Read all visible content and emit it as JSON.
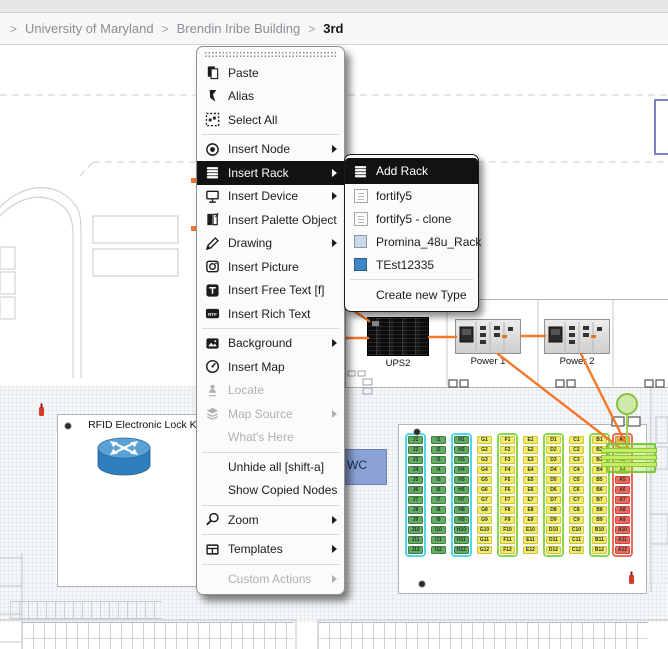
{
  "breadcrumb": {
    "separator": ">",
    "items": [
      {
        "label": "University of Maryland"
      },
      {
        "label": "Brendin Iribe Building"
      },
      {
        "label": "3rd",
        "current": true
      }
    ]
  },
  "context_menu": {
    "rtf_icon_text": "RTF",
    "items": [
      {
        "label": "Paste",
        "icon": "paste-icon"
      },
      {
        "label": "Alias",
        "icon": "alias-icon"
      },
      {
        "label": "Select All",
        "icon": "select-all-icon",
        "separator_after": true
      },
      {
        "label": "Insert Node",
        "icon": "node-icon",
        "submenu": true
      },
      {
        "label": "Insert Rack",
        "icon": "rack-icon",
        "submenu": true,
        "highlighted": true
      },
      {
        "label": "Insert Device",
        "icon": "device-icon",
        "submenu": true
      },
      {
        "label": "Insert Palette Object",
        "icon": "palette-icon",
        "submenu": true
      },
      {
        "label": "Drawing",
        "icon": "pencil-icon",
        "submenu": true
      },
      {
        "label": "Insert Picture",
        "icon": "camera-icon"
      },
      {
        "label": "Insert Free Text [f]",
        "icon": "text-icon"
      },
      {
        "label": "Insert Rich Text",
        "icon": "rtf-icon",
        "separator_after": true
      },
      {
        "label": "Background",
        "icon": "image-icon",
        "submenu": true
      },
      {
        "label": "Insert Map",
        "icon": "compass-icon"
      },
      {
        "label": "Locate",
        "icon": "person-pin-icon",
        "disabled": true
      },
      {
        "label": "Map Source",
        "icon": "layers-icon",
        "submenu": true,
        "disabled": true
      },
      {
        "label": "What's Here",
        "icon": null,
        "disabled": true,
        "separator_after": true
      },
      {
        "label": "Unhide all [shift-a]",
        "icon": null
      },
      {
        "label": "Show Copied Nodes",
        "icon": null,
        "separator_after": true
      },
      {
        "label": "Zoom",
        "icon": "magnifier-icon",
        "submenu": true,
        "separator_after": true
      },
      {
        "label": "Templates",
        "icon": "window-icon",
        "submenu": true,
        "separator_after": true
      },
      {
        "label": "Custom Actions",
        "icon": null,
        "submenu": true,
        "disabled": true
      }
    ]
  },
  "rack_submenu": {
    "items": [
      {
        "label": "Add Rack",
        "icon": "rack-icon",
        "highlighted": true
      },
      {
        "label": "fortify5",
        "icon": "test-image-icon"
      },
      {
        "label": "fortify5 - clone",
        "icon": "test-image-icon"
      },
      {
        "label": "Promina_48u_Rack",
        "icon": "color-swatch",
        "swatch_color": "#c9d9ea"
      },
      {
        "label": "TEst12335",
        "icon": "color-swatch",
        "swatch_color": "#3e86c6",
        "separator_after": true
      },
      {
        "label": "Create new Type",
        "icon": null
      }
    ]
  },
  "map": {
    "room_labels": {
      "rfid": "RFID Electronic Lock Kit",
      "wc": "WC"
    },
    "devices": [
      {
        "label": "UPS2"
      },
      {
        "label": "Power 1"
      },
      {
        "label": "Power 2"
      }
    ],
    "rack_grid": {
      "rows": 12,
      "columns": [
        {
          "letter": "J",
          "cell_color": "green",
          "outline": "cyan"
        },
        {
          "letter": "I",
          "cell_color": "green",
          "outline": null
        },
        {
          "letter": "H",
          "cell_color": "green",
          "outline": "cyan"
        },
        {
          "letter": "G",
          "cell_color": "yellow",
          "outline": null
        },
        {
          "letter": "F",
          "cell_color": "yellow",
          "outline": "green"
        },
        {
          "letter": "E",
          "cell_color": "yellow",
          "outline": null
        },
        {
          "letter": "D",
          "cell_color": "yellow",
          "outline": "green"
        },
        {
          "letter": "C",
          "cell_color": "yellow",
          "outline": null
        },
        {
          "letter": "B",
          "cell_color": "yellow",
          "outline": "green"
        },
        {
          "letter": "A",
          "cell_color": "mixed",
          "outline": "red",
          "cell_colors": [
            "orange",
            "yellow",
            "yellow",
            "yellow",
            "red",
            "red",
            "red",
            "red",
            "red",
            "red",
            "red",
            "red"
          ]
        }
      ]
    },
    "colors": {
      "cell_green": "#63ad63",
      "cell_green_border": "#3f7f3f",
      "cell_yellow": "#f3ec6a",
      "cell_yellow_border": "#cfc53a",
      "cell_red": "#ef6a5e",
      "cell_red_border": "#c8453c",
      "cell_orange": "#f0b04a",
      "cell_orange_border": "#d89030",
      "outline_cyan": "#4fd8e8",
      "outline_green": "#86d94e",
      "outline_red": "#ef6a5e",
      "connection_orange": "#f4772a",
      "selection_lime": "#b9ee58",
      "wc_blue": "#8ba2d6"
    }
  }
}
